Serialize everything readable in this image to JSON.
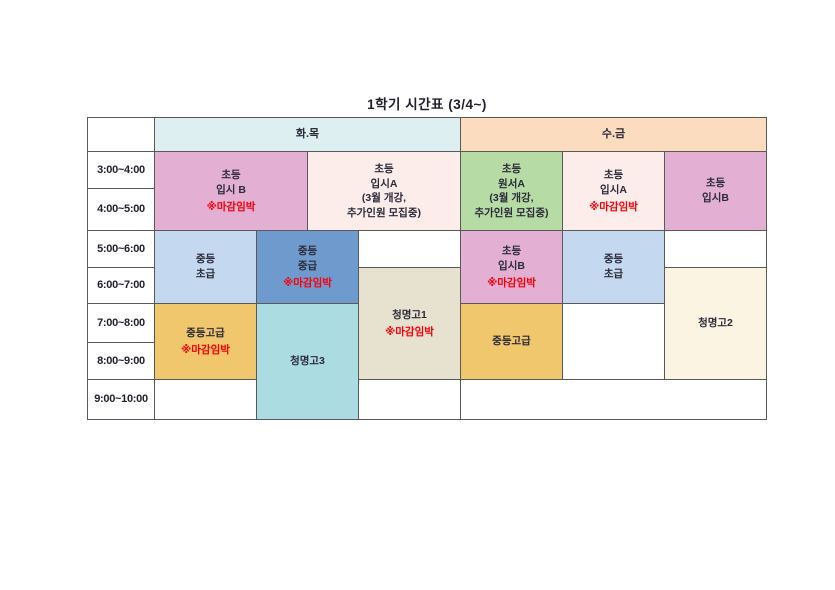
{
  "page": {
    "title": "1학기 시간표 (3/4~)"
  },
  "colors": {
    "grid_line": "#595959",
    "text": "#2b2b3a",
    "deadline_red": "#f80007",
    "tue_thu_header": "#ddeff1",
    "wed_fri_header": "#fcdcbe",
    "pink": "#e3b0d4",
    "light_pink": "#fcecea",
    "green": "#b7dba4",
    "light_blue": "#c4d9ef",
    "blue": "#6e9ace",
    "gold": "#f0c76d",
    "beige": "#e7e2cf",
    "cyan": "#abdce1",
    "cream": "#fcf4e2"
  },
  "table": {
    "day_headers": {
      "tue_thu": "화.목",
      "wed_fri": "수.금"
    },
    "time_slots": [
      "3:00~4:00",
      "4:00~5:00",
      "5:00~6:00",
      "6:00~7:00",
      "7:00~8:00",
      "8:00~9:00",
      "9:00~10:00"
    ],
    "cells": {
      "tt_elem_ipsi_b": {
        "line1": "초등",
        "line2": "입시 B",
        "badge": "※마감임박"
      },
      "tt_elem_ipsi_a": {
        "line1": "초등",
        "line2": "입시A",
        "line3": "(3월 개강,",
        "line4": "추가인원 모집중)"
      },
      "wf_elem_wonseo_a": {
        "line1": "초등",
        "line2": "원서A",
        "line3": "(3월 개강,",
        "line4": "추가인원 모집중)"
      },
      "wf_elem_ipsi_a": {
        "line1": "초등",
        "line2": "입시A",
        "badge": "※마감임박"
      },
      "wf_elem_ipsi_b_early": {
        "line1": "초등",
        "line2": "입시B"
      },
      "tt_middle_beginner": {
        "line1": "중등",
        "line2": "초급"
      },
      "tt_middle_inter": {
        "line1": "중등",
        "line2": "중급",
        "badge": "※마감임박"
      },
      "tt_cheongmyeong_go1": {
        "line1": "청명고1",
        "badge": "※마감임박"
      },
      "wf_elem_ipsi_b_late": {
        "line1": "초등",
        "line2": "입시B",
        "badge": "※마감임박"
      },
      "wf_middle_beginner": {
        "line1": "중등",
        "line2": "초급"
      },
      "tt_middle_adv": {
        "line1": "중등고급",
        "badge": "※마감임박"
      },
      "tt_cheongmyeong_go3": {
        "line1": "청명고3"
      },
      "wf_middle_adv": {
        "line1": "중등고급"
      },
      "wf_cheongmyeong_go2": {
        "line1": "청명고2"
      }
    }
  }
}
